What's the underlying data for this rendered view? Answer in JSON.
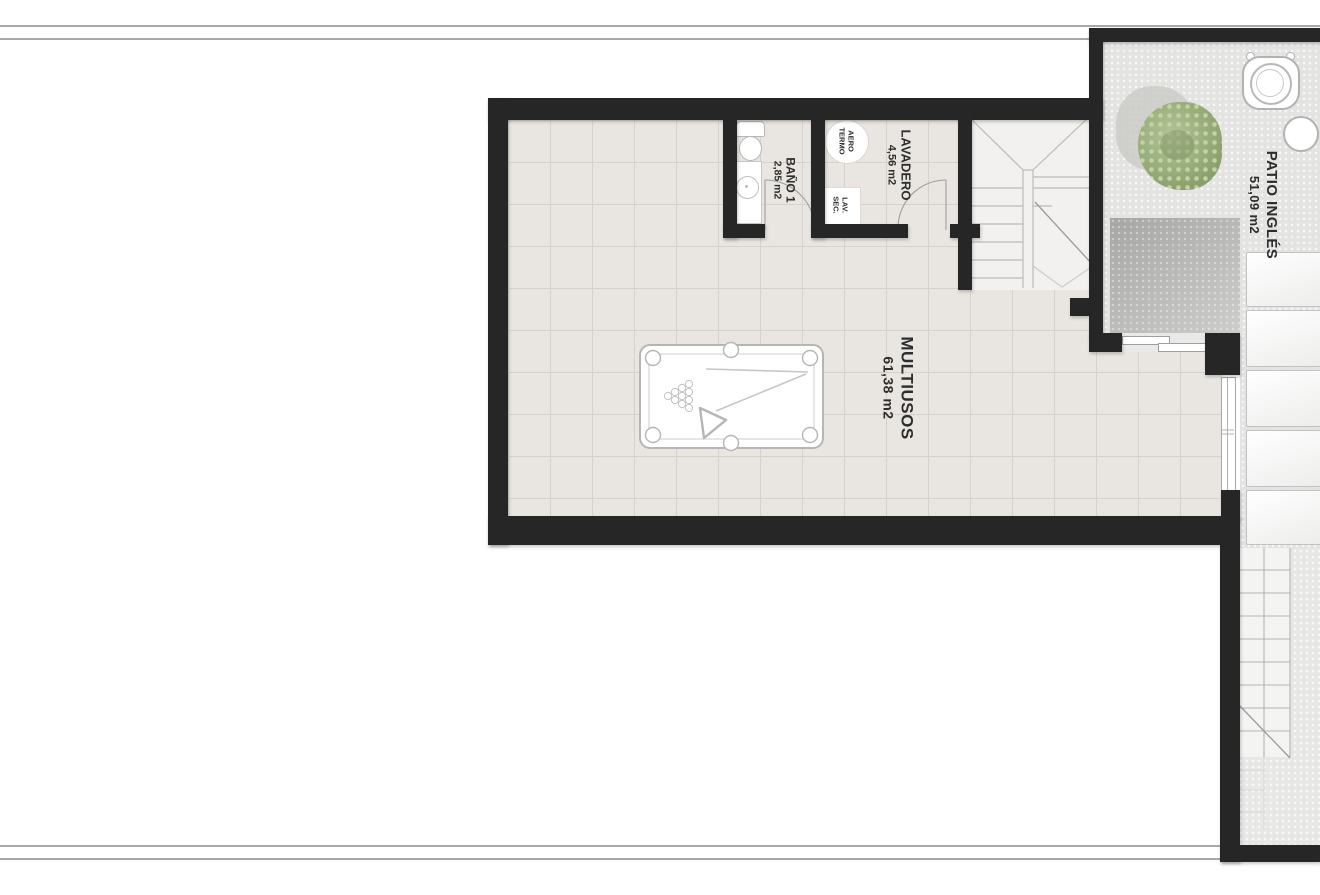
{
  "plan_title": "Basement floor plan",
  "rooms": {
    "multiusos": {
      "name": "MULTIUSOS",
      "area": "61,38 m2"
    },
    "bano": {
      "name": "BAÑO 1",
      "area": "2,85 m2"
    },
    "lavadero": {
      "name": "LAVADERO",
      "area": "4,56 m2"
    },
    "patio": {
      "name": "PATIO INGLÉS",
      "area": "51,09 m2"
    }
  },
  "fixtures": {
    "aerotermo": {
      "line1": "AERO",
      "line2": "TERMO"
    },
    "lavsec": {
      "line1": "LAV.",
      "line2": "SEC."
    }
  },
  "colors": {
    "wall": "#262626",
    "floor_tile": "#e9e6e1",
    "patio_gravel": "#e3e3e2",
    "tree_green": "#9cb07e"
  }
}
